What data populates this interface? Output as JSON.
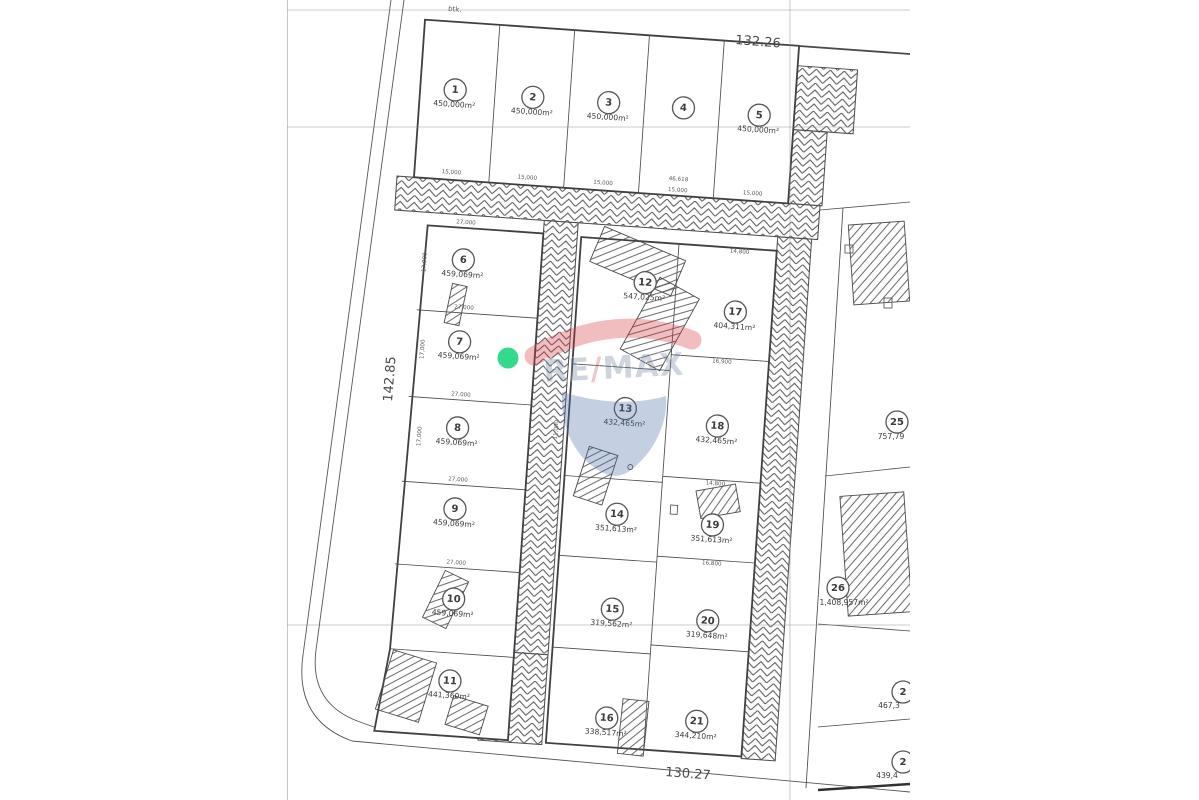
{
  "dimensions": {
    "top": "132.26",
    "left": "142.85",
    "bottom": "130.27"
  },
  "corner_note": "btk.",
  "marker_color": "#35d98b",
  "watermark": {
    "re": "RE",
    "slash": "/",
    "max": "MAX",
    "red": "#d8343c",
    "blue": "#4a70a8"
  },
  "plots": [
    {
      "id": "1",
      "area": "450,000m²"
    },
    {
      "id": "2",
      "area": "450,000m²"
    },
    {
      "id": "3",
      "area": "450,000m²"
    },
    {
      "id": "4",
      "area": ""
    },
    {
      "id": "5",
      "area": "450,000m²"
    },
    {
      "id": "6",
      "area": "459,069m²"
    },
    {
      "id": "7",
      "area": "459,069m²"
    },
    {
      "id": "8",
      "area": "459,069m²"
    },
    {
      "id": "9",
      "area": "459,069m²"
    },
    {
      "id": "10",
      "area": "459,069m²"
    },
    {
      "id": "11",
      "area": "441,360m²"
    },
    {
      "id": "12",
      "area": "547,025m²"
    },
    {
      "id": "13",
      "area": "432,465m²"
    },
    {
      "id": "14",
      "area": "351,613m²"
    },
    {
      "id": "15",
      "area": "319,562m²"
    },
    {
      "id": "16",
      "area": "338,517m²"
    },
    {
      "id": "17",
      "area": "404,311m²"
    },
    {
      "id": "18",
      "area": "432,465m²"
    },
    {
      "id": "19",
      "area": "351,613m²"
    },
    {
      "id": "20",
      "area": "319,648m²"
    },
    {
      "id": "21",
      "area": "344,210m²"
    },
    {
      "id": "25",
      "area": "757,79"
    },
    {
      "id": "26",
      "area": "1,408,957m²"
    },
    {
      "id": "2",
      "area": "467,3"
    },
    {
      "id": "2",
      "area": "439,4"
    }
  ],
  "ticks": [
    "15,000",
    "15,000",
    "15,000",
    "46,618",
    "15,000",
    "15,000",
    "27,000",
    "27,000",
    "27,000",
    "27,000",
    "27,000",
    "17,000",
    "17,000",
    "17,000",
    "14,800",
    "16,900",
    "14,800",
    "16,800",
    "11,000"
  ]
}
